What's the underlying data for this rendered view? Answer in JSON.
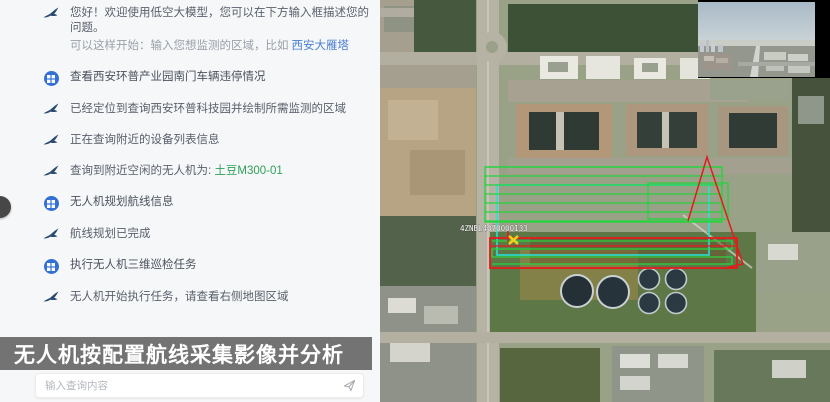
{
  "chat": {
    "messages": [
      {
        "role": "assistant",
        "text": "您好！欢迎使用低空大模型，您可以在下方输入框描述您的问题。"
      },
      {
        "role": "hint",
        "text": "可以这样开始：输入您想监测的区域，比如",
        "link": "西安大雁塔"
      },
      {
        "role": "user",
        "text": "查看西安环普产业园南门车辆违停情况"
      },
      {
        "role": "assistant",
        "text": "已经定位到查询西安环普科技园并绘制所需监测的区域"
      },
      {
        "role": "assistant",
        "text": "正在查询附近的设备列表信息"
      },
      {
        "role": "assistant",
        "text": "查询到附近空闲的无人机为: ",
        "highlight": "土豆M300-01"
      },
      {
        "role": "user",
        "text": "无人机规划航线信息"
      },
      {
        "role": "assistant",
        "text": "航线规划已完成"
      },
      {
        "role": "user",
        "text": "执行无人机三维巡检任务"
      },
      {
        "role": "assistant",
        "text": "无人机开始执行任务，请查看右侧地图区域"
      }
    ],
    "input": {
      "placeholder": "输入查询内容"
    }
  },
  "caption": {
    "text": "无人机按配置航线采集影像并分析"
  },
  "map": {
    "drone_label": "4ZNBL4070000133",
    "overlay_colors": {
      "flight_route_green": "#27d43f",
      "survey_area_cyan": "#25e3d2",
      "alert_area_red": "#e41b1b",
      "drone_marker_yellow": "#f2cf1f"
    }
  },
  "icons": {
    "assistant": "bird-logo-icon",
    "user": "user-avatar-icon",
    "send": "paper-plane-icon",
    "drone": "drone-marker-icon"
  }
}
